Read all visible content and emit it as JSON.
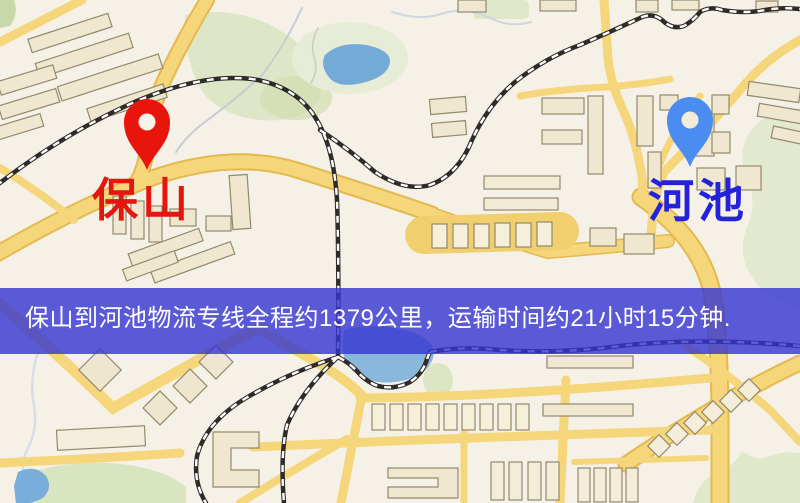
{
  "banner": {
    "text": "保山到河池物流专线全程约1379公里，运输时间约21小时15分钟.",
    "background": "#3434D2",
    "background_opacity": "0.80",
    "text_color": "#FFFFFF"
  },
  "markers": {
    "origin": {
      "label": "保山",
      "pin_color": "#E8150C",
      "label_color": "#E3170E"
    },
    "destination": {
      "label": "河池",
      "pin_color": "#4B8CF0",
      "label_color": "#2522DC"
    }
  },
  "map_palette": {
    "background": "#F6F1E7",
    "road_fill": "#F5D67A",
    "road_casing": "#E4B94F",
    "building_fill": "#EFE7CF",
    "building_light": "#F6EFDC",
    "building_outline": "#93896D",
    "park_green": "#DDE6C6",
    "park_green_dark": "#D2DEB2",
    "water_blue": "#7FAEDA",
    "railway_black": "#2E2B28",
    "railway_dash": "#FFFFFF"
  }
}
